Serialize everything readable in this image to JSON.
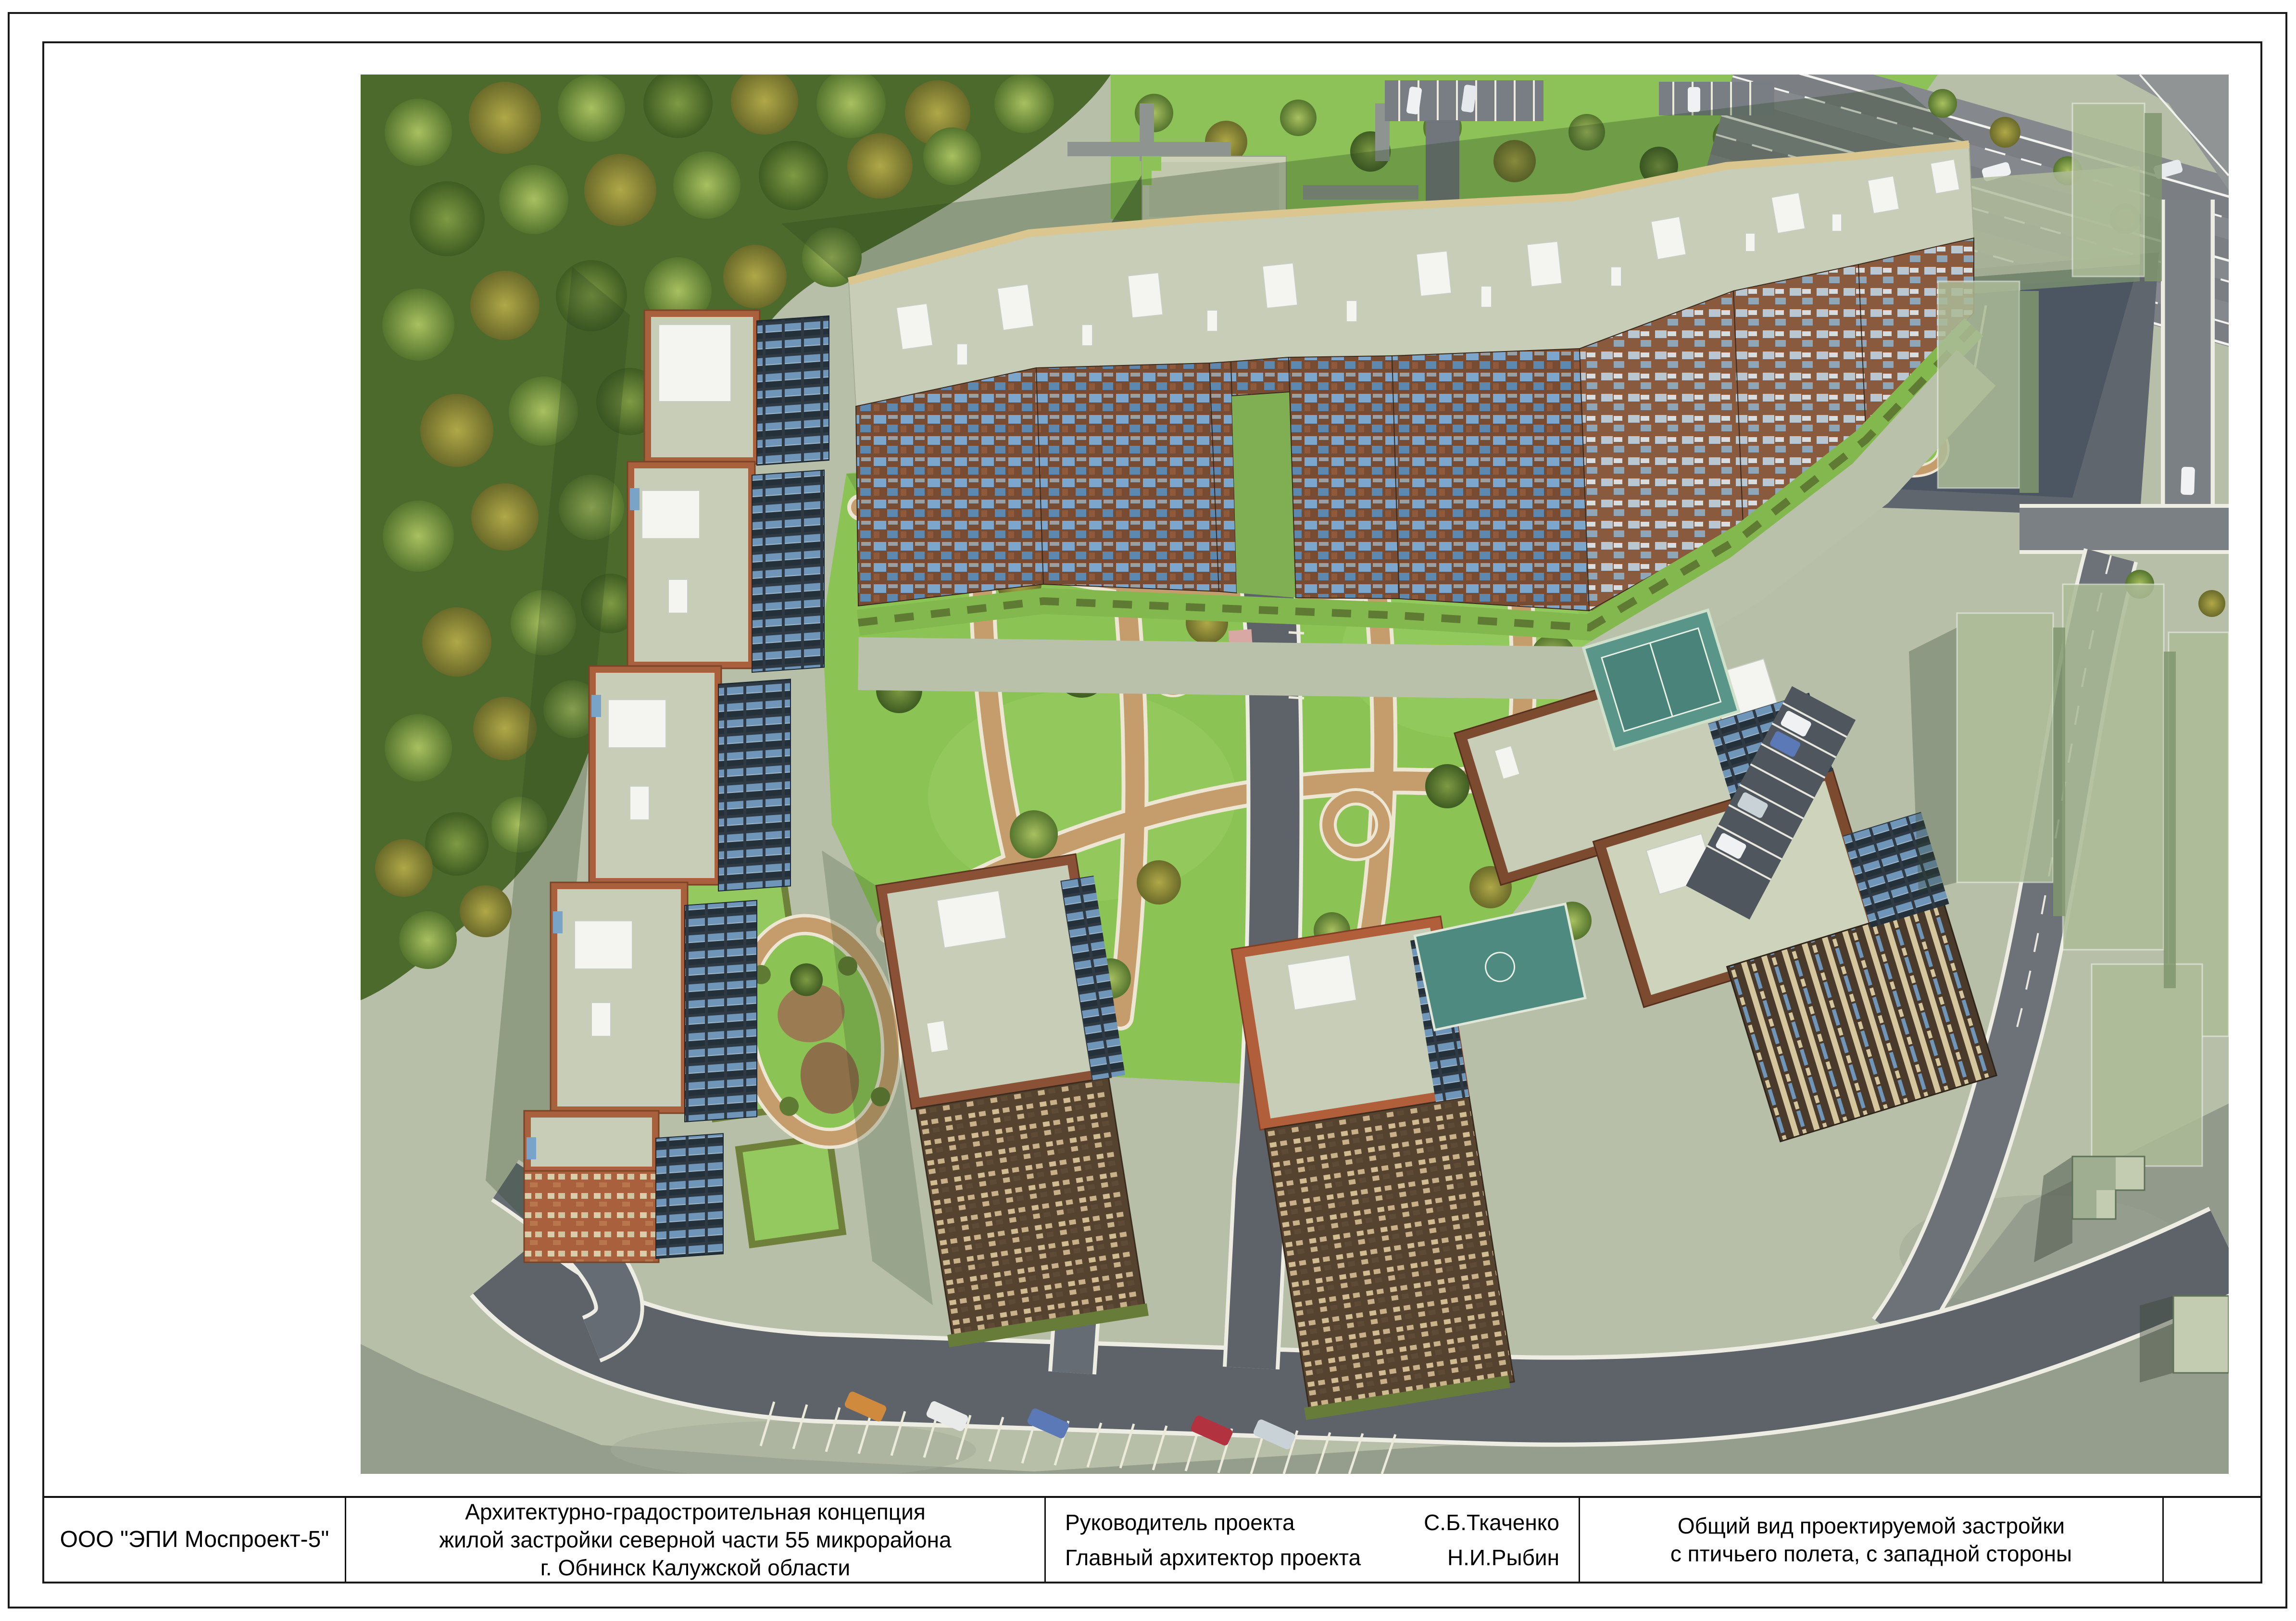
{
  "title_block": {
    "company": "ООО \"ЭПИ Моспроект-5\"",
    "project": {
      "line1": "Архитектурно-градостроительная концепция",
      "line2": "жилой застройки северной части 55 микрорайона",
      "line3": "г. Обнинск Калужской области"
    },
    "signatures": [
      {
        "label": "Руководитель проекта",
        "name": "С.Б.Ткаченко"
      },
      {
        "label": "Главный архитектор проекта",
        "name": "Н.И.Рыбин"
      }
    ],
    "sheet_title": {
      "line1": "Общий вид проектируемой застройки",
      "line2": "с птичьего полета, с западной стороны"
    }
  },
  "render": {
    "colors": {
      "forest_green": "#4c6a2c",
      "lawn_green": "#8bc355",
      "park_path_tan": "#c59c6c",
      "brick_facade": "#774c33",
      "balcony_blue": "#7ca6cc",
      "roof_sage": "#c7cdb6",
      "parapet_tan": "#dbc690",
      "asphalt_gray": "#5d6369",
      "ghost_building_green": "#aebc98",
      "court_teal": "#4f8a80"
    }
  }
}
